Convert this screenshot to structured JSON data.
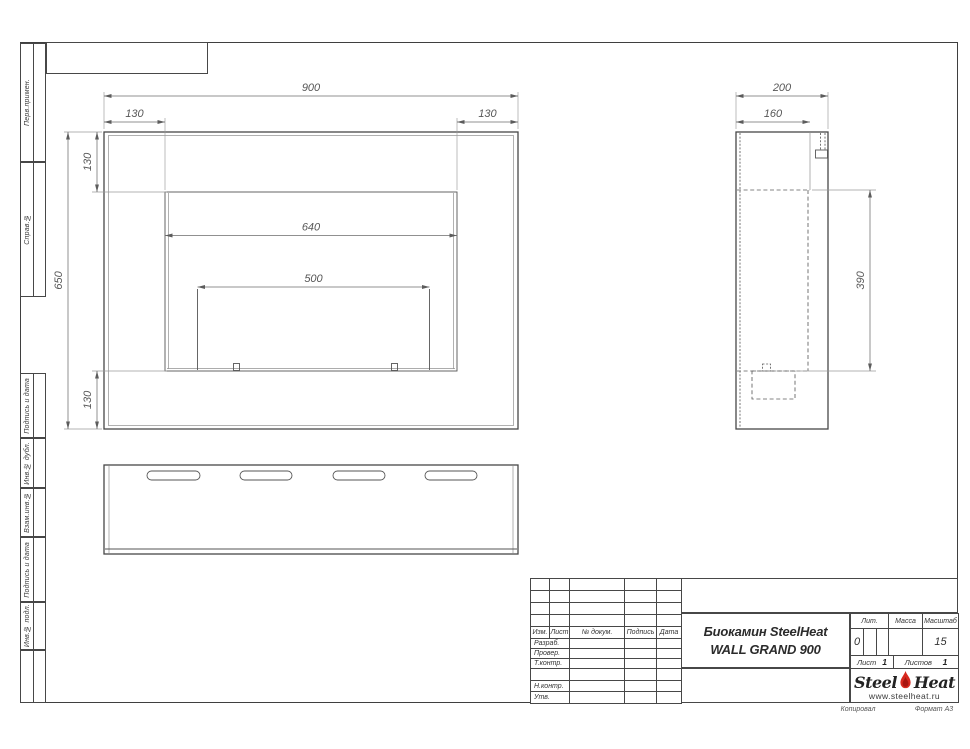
{
  "page": {
    "copied_label": "Копировал",
    "format_label": "Формат А3"
  },
  "left_strip": {
    "boxes": [
      {
        "label": "Перв.примен."
      },
      {
        "label": "Справ.№"
      },
      {
        "label": "Подпись и дата"
      },
      {
        "label": "Инв.№ дубл."
      },
      {
        "label": "Взам.инв.№"
      },
      {
        "label": "Подпись и дата"
      },
      {
        "label": "Инв.№ подл."
      }
    ]
  },
  "drawing": {
    "front_view": {
      "overall_width": "900",
      "side_margin_left": "130",
      "side_margin_right": "130",
      "overall_height": "650",
      "top_margin": "130",
      "bottom_margin": "130",
      "opening_width": "640",
      "burner_width": "500"
    },
    "side_view": {
      "overall_depth": "200",
      "inner_depth": "160",
      "opening_height": "390"
    }
  },
  "title_block": {
    "change_table_headers": [
      "Изм.",
      "Лист",
      "№ докум.",
      "Подпись",
      "Дата"
    ],
    "role_rows": [
      "Разраб.",
      "Провер.",
      "Т.контр.",
      "Н.контр.",
      "Утв."
    ],
    "doc_title_line1": "Биокамин SteelHeat",
    "doc_title_line2": "WALL GRAND 900",
    "lit_label": "Лит.",
    "lit_value": "0",
    "mass_label": "Масса",
    "mass_value": "",
    "scale_label": "Масштаб",
    "scale_value": "15",
    "sheet_label": "Лист",
    "sheet_number": "1",
    "sheets_label": "Листов",
    "sheets_total": "1",
    "logo": {
      "part1": "Steel",
      "part2": "Heat",
      "website": "www.steelheat.ru",
      "flame_color": "#d7281e",
      "flame_inner_color": "#a8150f"
    }
  },
  "colors": {
    "line": "#474747",
    "dimension": "#575757",
    "flame_red": "#d7281e"
  }
}
